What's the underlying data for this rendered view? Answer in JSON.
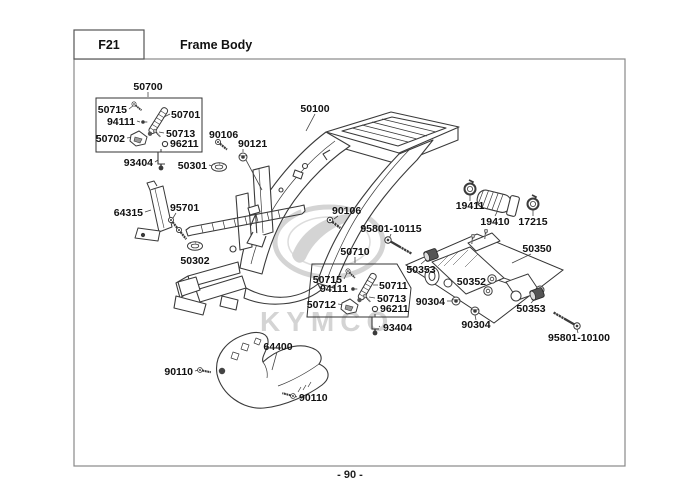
{
  "header": {
    "code": "F21",
    "title": "Frame Body"
  },
  "footer": {
    "page_number": "- 90 -"
  },
  "watermark": {
    "brand": "KYMCO"
  },
  "colors": {
    "line_art": "#3a3a3a",
    "label_text": "#111111",
    "watermark": "#d4d4d4",
    "page_background": "#ffffff",
    "border": "#888888"
  },
  "parts": {
    "p50700": "50700",
    "p50715_a": "50715",
    "p94111_a": "94111",
    "p50701": "50701",
    "p50702": "50702",
    "p50713_a": "50713",
    "p96211_a": "96211",
    "p93404_a": "93404",
    "p50301": "50301",
    "p90106_a": "90106",
    "p90121": "90121",
    "p50100": "50100",
    "p64315": "64315",
    "p95701": "95701",
    "p50302": "50302",
    "p90106_b": "90106",
    "p95801_10115": "95801-10115",
    "p50710": "50710",
    "p50715_b": "50715",
    "p94111_b": "94111",
    "p50711": "50711",
    "p50713_b": "50713",
    "p50712": "50712",
    "p96211_b": "96211",
    "p93404_b": "93404",
    "p19411": "19411",
    "p19410": "19410",
    "p17215": "17215",
    "p50350": "50350",
    "p50353_l": "50353",
    "p50352": "50352",
    "p90304_a": "90304",
    "p90304_b": "90304",
    "p50353_r": "50353",
    "p95801_10100": "95801-10100",
    "p64400": "64400",
    "p90110_a": "90110",
    "p90110_b": "90110"
  }
}
